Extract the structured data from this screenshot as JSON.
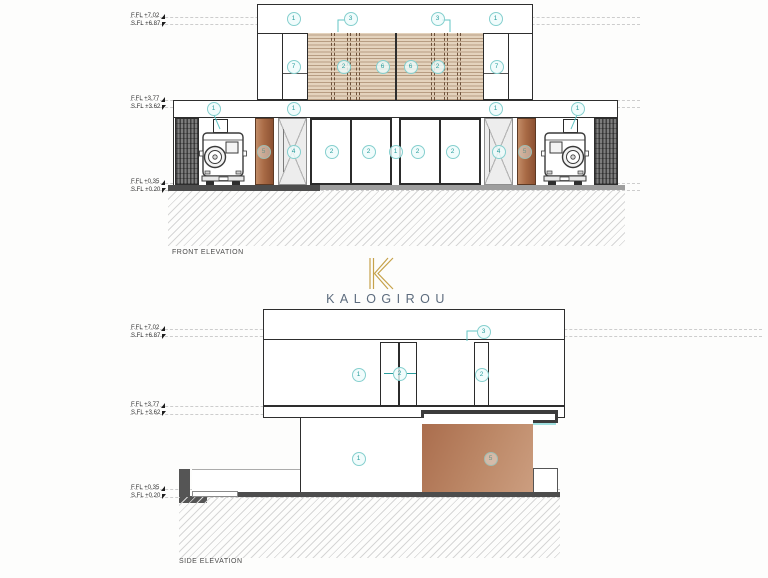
{
  "titles": {
    "front": "FRONT ELEVATION",
    "side": "SIDE ELEVATION"
  },
  "brand": {
    "name": "KALOGIROU",
    "gold": "#c6a24b",
    "text_color": "#5c6b7d"
  },
  "levels": {
    "roof": {
      "ffl": "F.FL +7.02",
      "sfl": "S.FL +6.87"
    },
    "first": {
      "ffl": "F.FL +3.77",
      "sfl": "S.FL +3.62"
    },
    "ground": {
      "ffl": "F.FL +0.35",
      "sfl": "S.FL +0.20"
    }
  },
  "front_keynotes": [
    {
      "n": "1",
      "x": 293,
      "y": 18
    },
    {
      "n": "3",
      "x": 350,
      "y": 18
    },
    {
      "n": "3",
      "x": 437,
      "y": 18
    },
    {
      "n": "1",
      "x": 495,
      "y": 18
    },
    {
      "n": "7",
      "x": 293,
      "y": 66
    },
    {
      "n": "2",
      "x": 343,
      "y": 66
    },
    {
      "n": "6",
      "x": 382,
      "y": 66
    },
    {
      "n": "6",
      "x": 410,
      "y": 66
    },
    {
      "n": "2",
      "x": 437,
      "y": 66
    },
    {
      "n": "7",
      "x": 496,
      "y": 66
    },
    {
      "n": "1",
      "x": 213,
      "y": 108
    },
    {
      "n": "1",
      "x": 293,
      "y": 108
    },
    {
      "n": "1",
      "x": 495,
      "y": 108
    },
    {
      "n": "1",
      "x": 577,
      "y": 108
    },
    {
      "n": "5",
      "x": 263,
      "y": 151,
      "muted": true
    },
    {
      "n": "4",
      "x": 293,
      "y": 151
    },
    {
      "n": "2",
      "x": 331,
      "y": 151
    },
    {
      "n": "2",
      "x": 368,
      "y": 151
    },
    {
      "n": "1",
      "x": 395,
      "y": 151
    },
    {
      "n": "2",
      "x": 417,
      "y": 151
    },
    {
      "n": "2",
      "x": 452,
      "y": 151
    },
    {
      "n": "4",
      "x": 498,
      "y": 151
    },
    {
      "n": "5",
      "x": 524,
      "y": 151,
      "muted": true
    }
  ],
  "side_keynotes": [
    {
      "n": "3",
      "x": 483,
      "y": 331
    },
    {
      "n": "1",
      "x": 358,
      "y": 374
    },
    {
      "n": "2",
      "x": 399,
      "y": 373,
      "arrows": true
    },
    {
      "n": "2",
      "x": 481,
      "y": 374
    },
    {
      "n": "1",
      "x": 358,
      "y": 458
    },
    {
      "n": "5",
      "x": 490,
      "y": 458,
      "muted": true
    }
  ],
  "colors": {
    "accent_teal": "#2b9e9e",
    "wood_slat": "#e4d3bd",
    "terracotta": "#b07251",
    "line": "#2e2e2e"
  }
}
